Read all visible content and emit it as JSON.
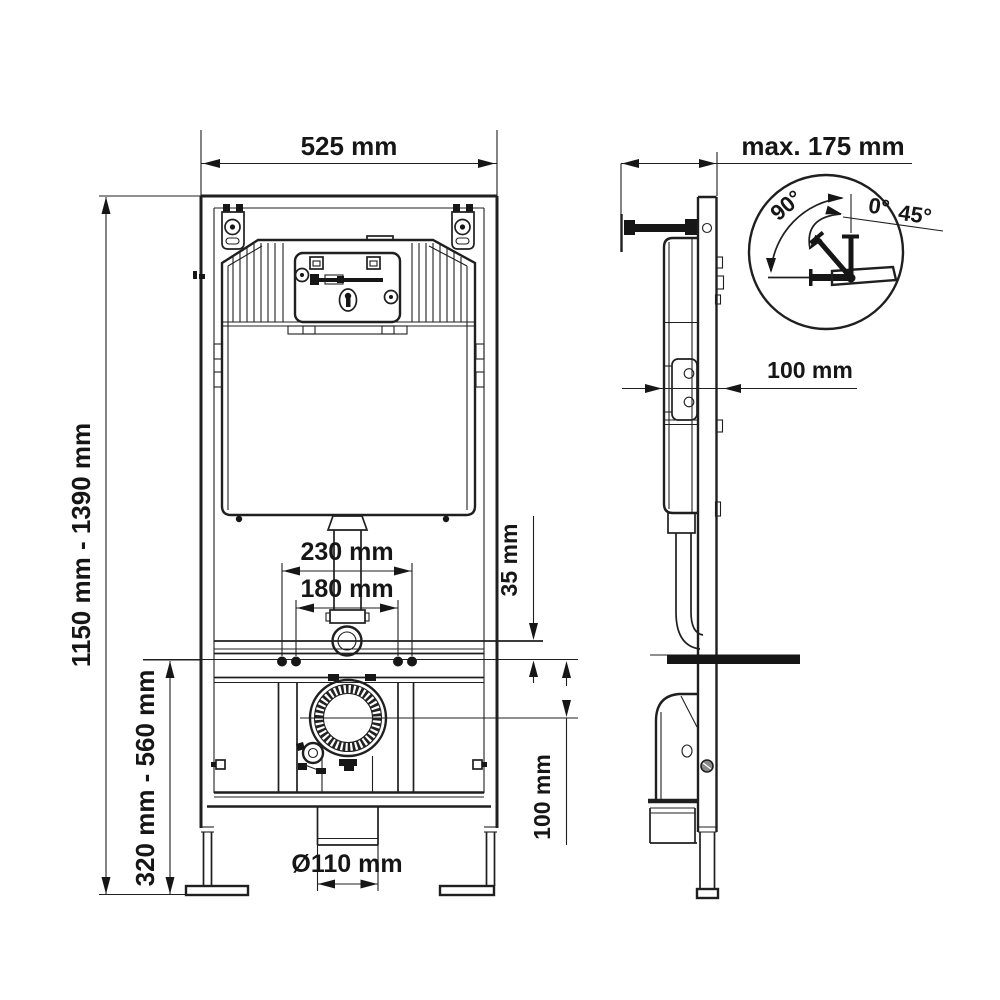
{
  "front_view": {
    "width_label": "525 mm",
    "height_range_label": "1150 mm - 1390 mm",
    "outlet_height_range_label": "320 mm - 560 mm",
    "bolt_spacing_outer_label": "230 mm",
    "bolt_spacing_inner_label": "180 mm",
    "rail_offset_label": "35 mm",
    "drain_axis_offset_label": "100 mm",
    "drain_pipe_diameter_label": "Ø110 mm"
  },
  "side_view": {
    "max_depth_label": "max. 175 mm",
    "bracket_depth_label": "100 mm"
  },
  "angle_detail": {
    "angle_90_label": "90°",
    "angle_0_label": "0°",
    "angle_45_label": "45°"
  },
  "colors": {
    "line": "#1f1f1f",
    "background": "#ffffff"
  }
}
